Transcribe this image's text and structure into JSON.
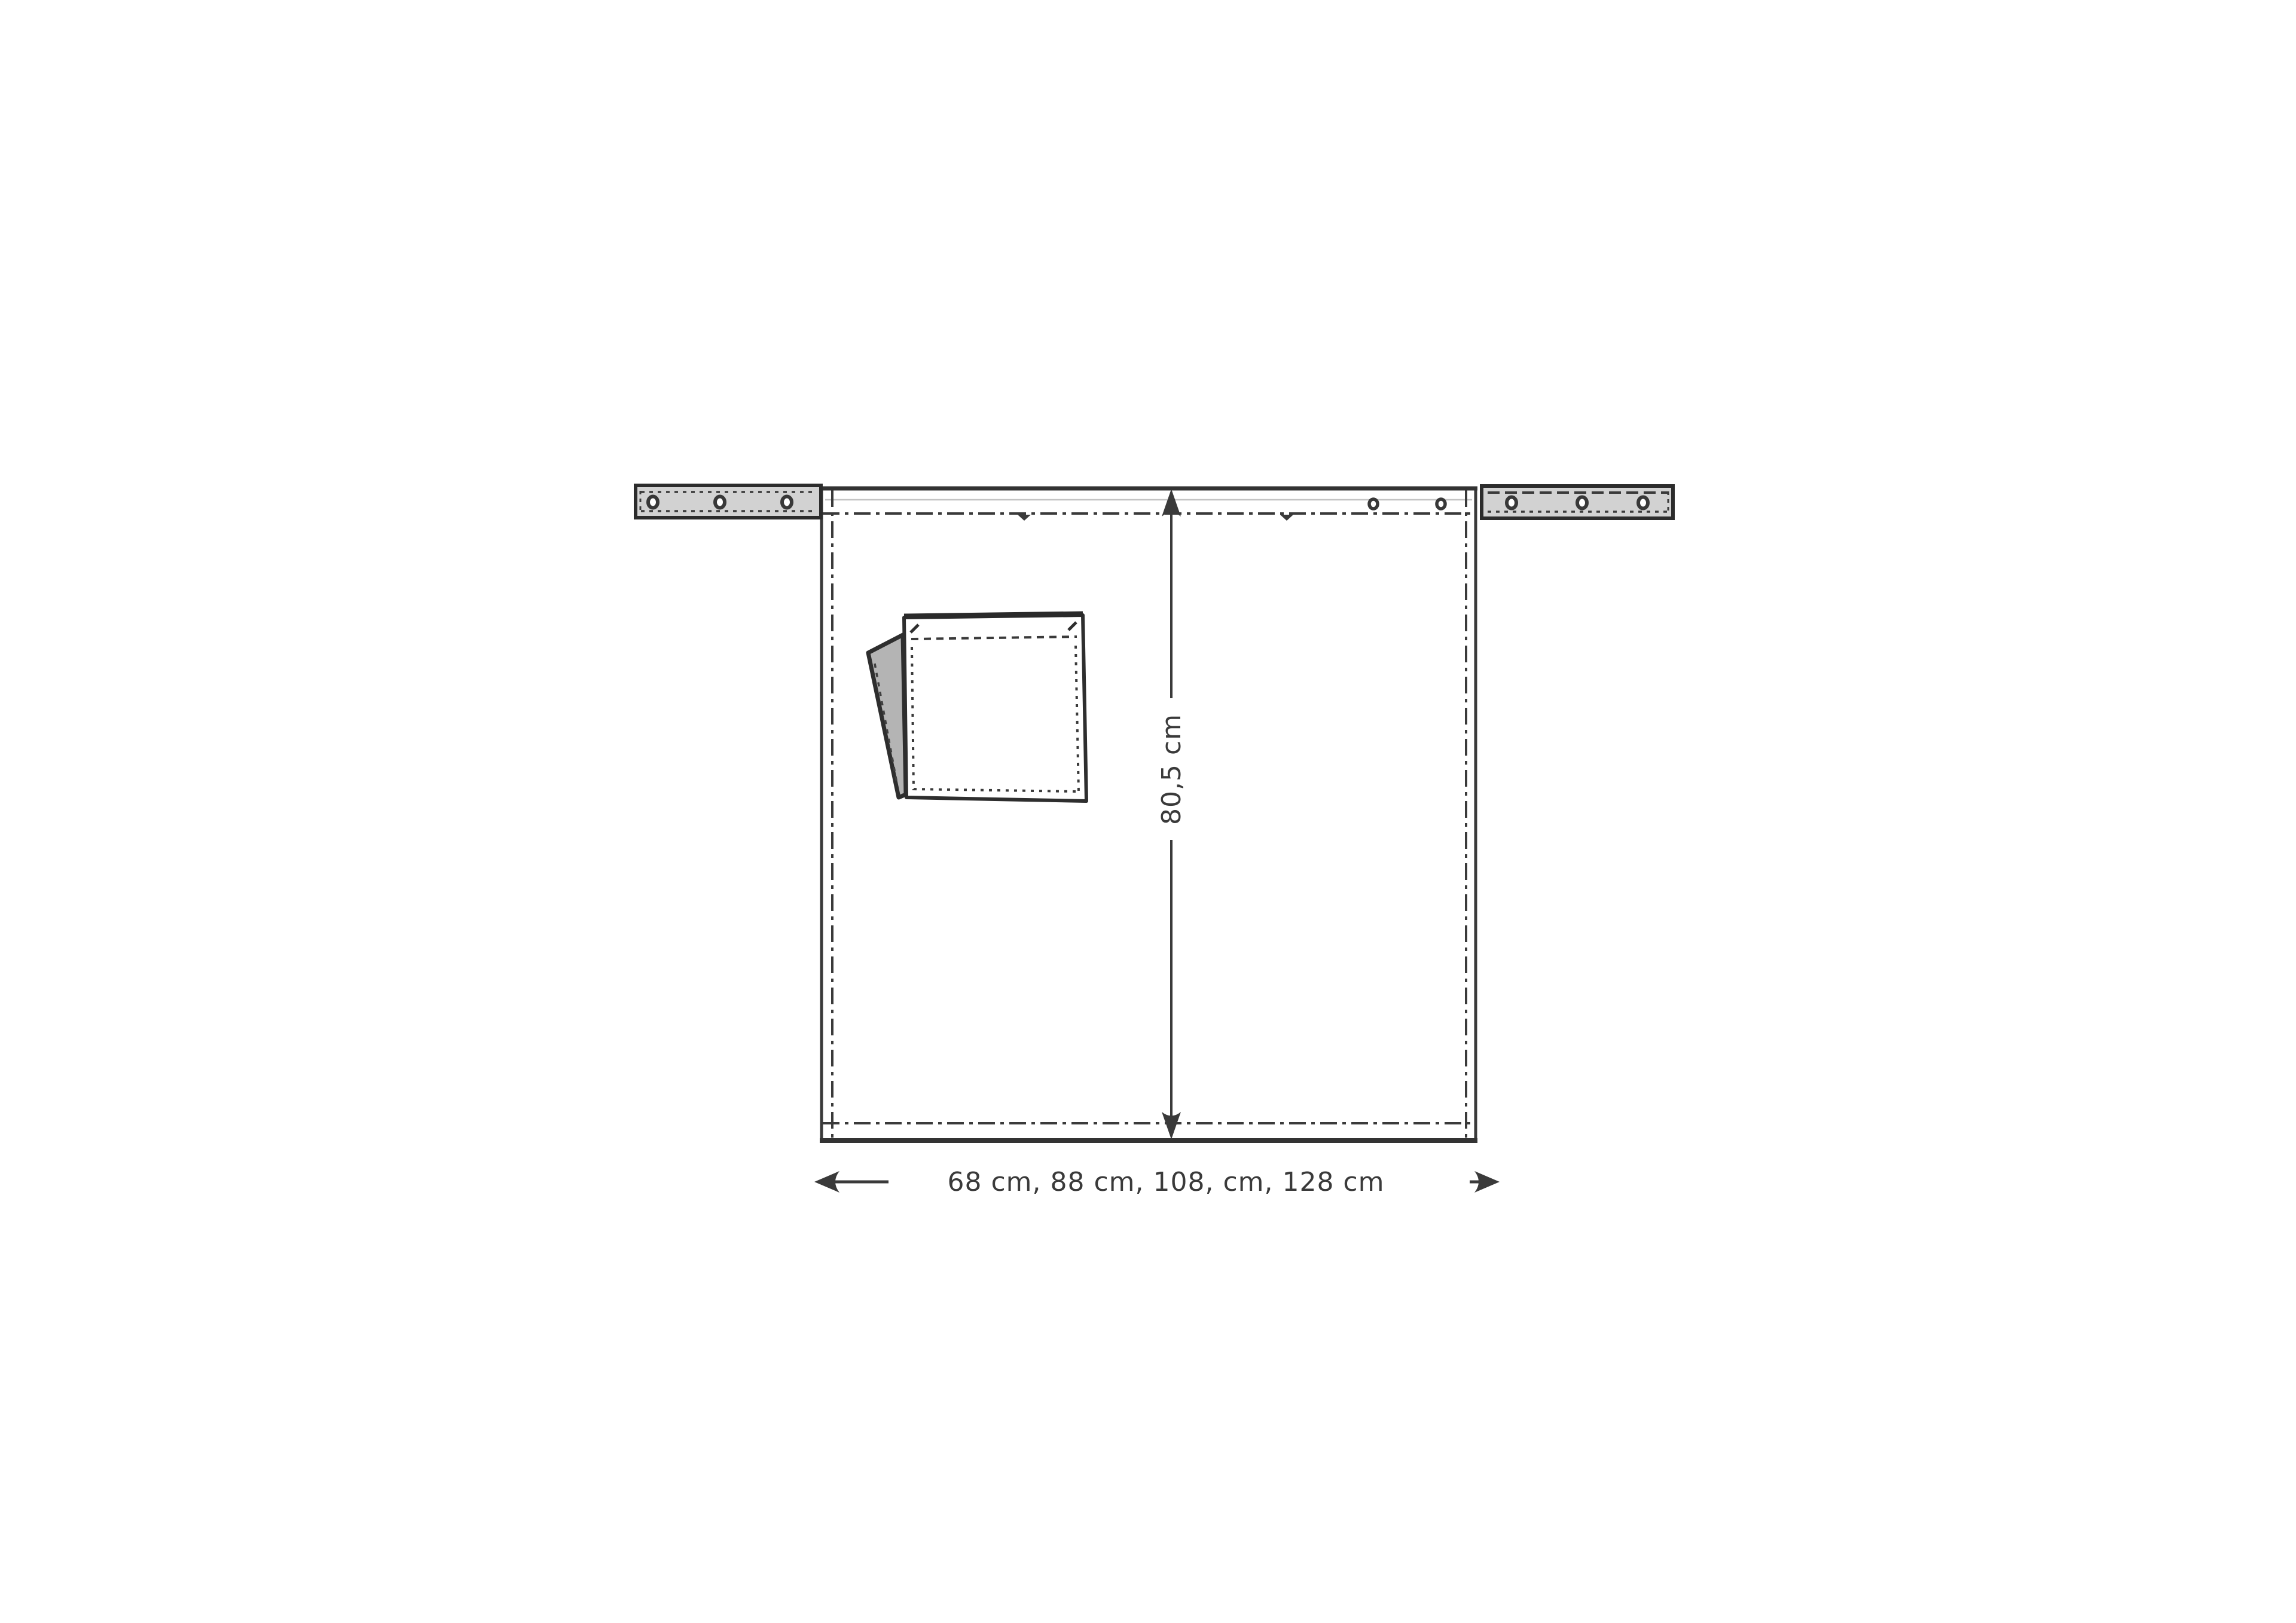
{
  "drawing": {
    "type": "technical-garment-drawing",
    "subject": "bistro apron, front view, flat sketch",
    "height_dimension": {
      "label": "80,5 cm",
      "orientation": "vertical"
    },
    "width_dimension": {
      "label": "68 cm, 88 cm, 108, cm, 128 cm",
      "orientation": "horizontal"
    },
    "colors": {
      "background": "#ffffff",
      "line": "#3a3a3a",
      "strap_fill": "#d2d2d2",
      "flap_fill": "#b4b4b4",
      "fabric_fill": "#ffffff",
      "light_stitch": "#c4c4c4"
    },
    "parts": {
      "left_strap_eyelet_count": 3,
      "right_strap_eyelet_count": 3,
      "waistband_eyelet_count": 2,
      "pocket": "patch pocket with folded gray flap and stitch lines"
    }
  }
}
